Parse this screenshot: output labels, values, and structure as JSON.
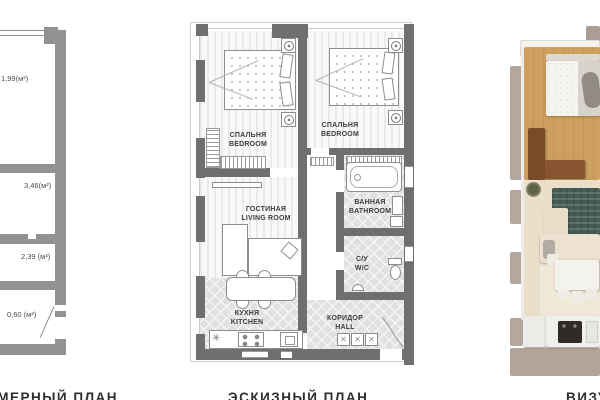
{
  "panels": {
    "measurement_plan": {
      "label": "ОБМЕРНЫЙ ПЛАН",
      "areas": [
        "1,99(м²)",
        "3,46(м²)",
        "2,39 (м²)",
        "0,60 (м²)"
      ]
    },
    "sketch_plan": {
      "label": "ЭСКИЗНЫЙ ПЛАН",
      "rooms": [
        {
          "ru": "СПАЛЬНЯ",
          "en": "BEDROOM"
        },
        {
          "ru": "СПАЛЬНЯ",
          "en": "BEDROOM"
        },
        {
          "ru": "ГОСТИНАЯ",
          "en": "LIVING ROOM"
        },
        {
          "ru": "ВАННАЯ",
          "en": "BATHROOM"
        },
        {
          "ru": "С/У",
          "en": "W/C"
        },
        {
          "ru": "КУХНЯ",
          "en": "KITCHEN"
        },
        {
          "ru": "КОРИДОР",
          "en": "HALL"
        }
      ]
    },
    "visualization": {
      "label": "ВИЗУАЛИЗАЦИЯ"
    }
  },
  "icons": {
    "sink_glyph": "✳",
    "wardrobe_cross_glyph": "✕"
  },
  "colors": {
    "wall_dark": "#6f6f6f",
    "wall_light": "#929292",
    "tile_floor": "#e1e1e1",
    "wood_floor": "#c99b59",
    "rug_teal": "#465c54",
    "sofa_cream": "#ece2cf",
    "furniture_brown": "#7a4b28"
  }
}
